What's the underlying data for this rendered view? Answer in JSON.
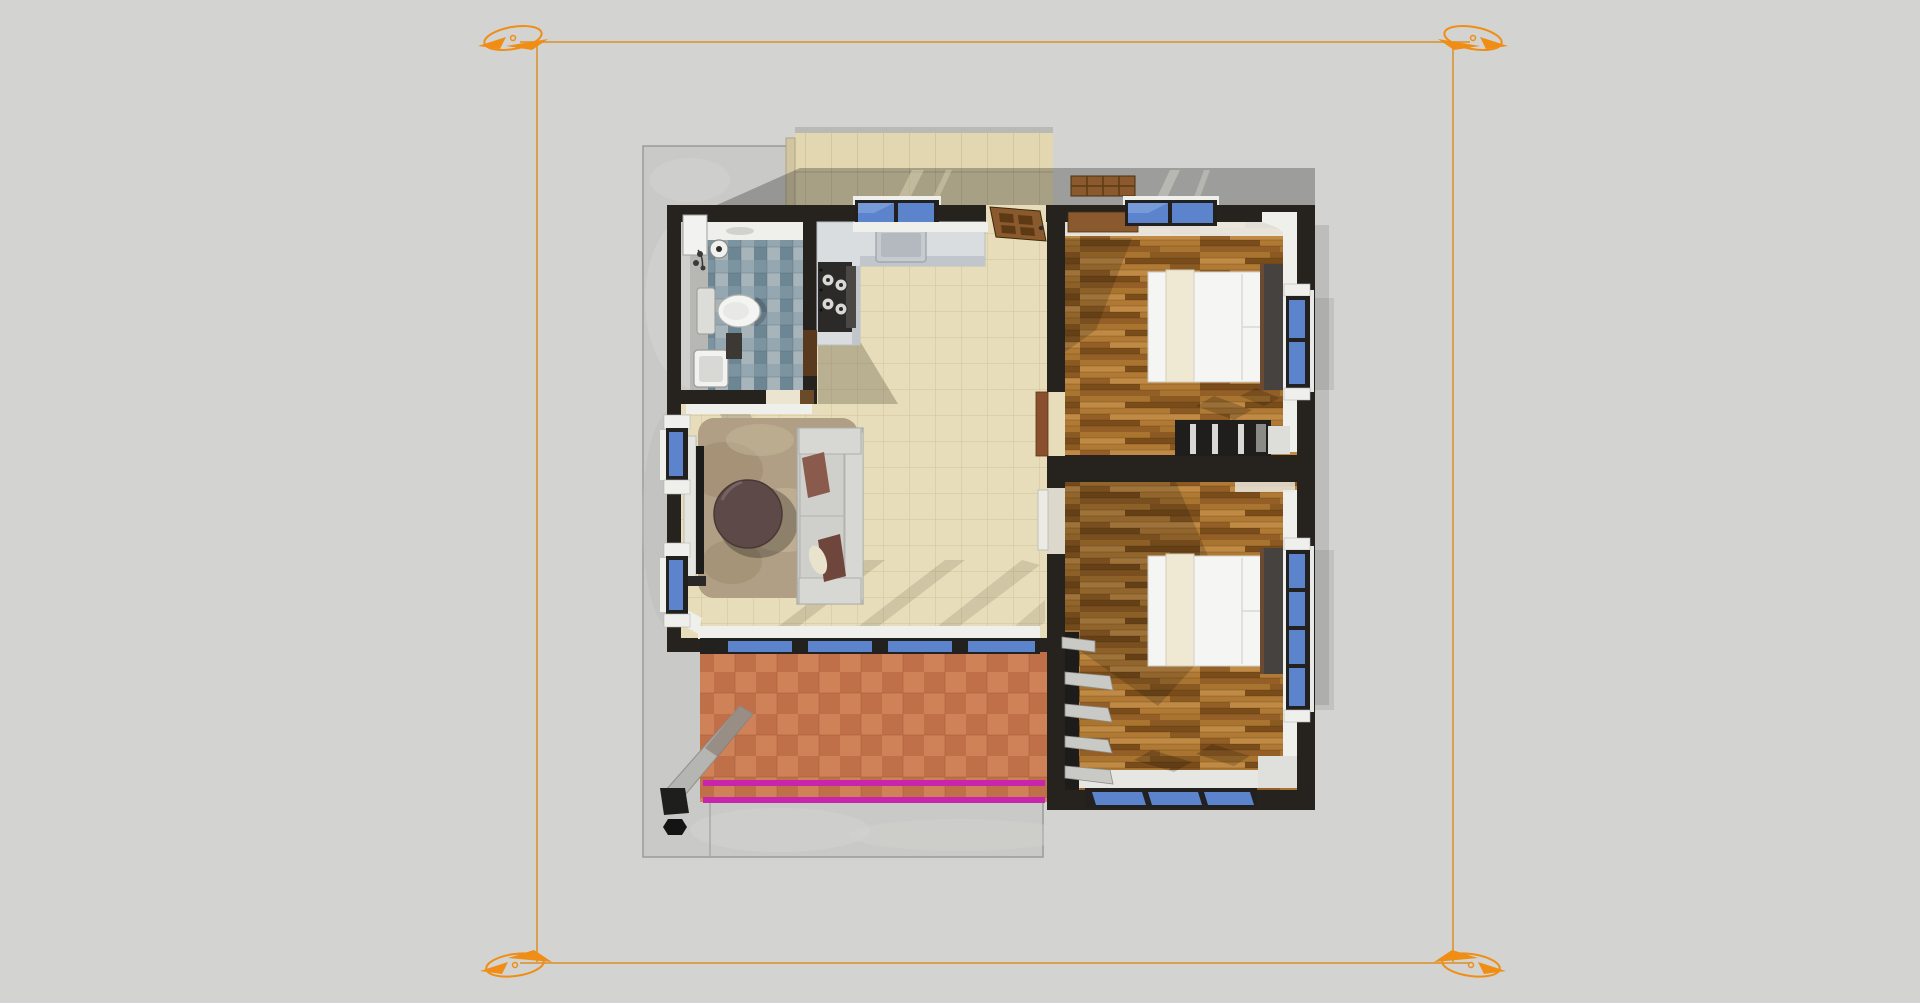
{
  "scene": {
    "type": "3d-floor-plan-top-view",
    "rooms": [
      {
        "name": "porch"
      },
      {
        "name": "bathroom"
      },
      {
        "name": "kitchen"
      },
      {
        "name": "living-room"
      },
      {
        "name": "bedroom-1"
      },
      {
        "name": "bedroom-2"
      },
      {
        "name": "terrace"
      }
    ],
    "furniture": [
      {
        "name": "toilet"
      },
      {
        "name": "bathroom-vanity-sink"
      },
      {
        "name": "kitchen-counter"
      },
      {
        "name": "kitchen-sink"
      },
      {
        "name": "stove"
      },
      {
        "name": "entry-door"
      },
      {
        "name": "porch-bench"
      },
      {
        "name": "sofa"
      },
      {
        "name": "coffee-table"
      },
      {
        "name": "area-rug"
      },
      {
        "name": "tv"
      },
      {
        "name": "bed-1"
      },
      {
        "name": "bed-2"
      },
      {
        "name": "wardrobe"
      },
      {
        "name": "shelving-unit"
      },
      {
        "name": "downspout-post"
      }
    ],
    "guides": [
      {
        "name": "section-plane-frame"
      },
      {
        "name": "section-corner-markers",
        "count": 4
      },
      {
        "name": "terrace-edge-lines-magenta",
        "count": 2
      }
    ]
  },
  "colors": {
    "bg": "#d3d3d1",
    "pad": "#c9c9c7",
    "wall": "#26231f",
    "porch": "#e2d7b0",
    "floor": "#e7ddba",
    "grout": "#cfc39b",
    "bath_a": "#7c93a0",
    "bath_b": "#95a7b0",
    "bath_c": "#6d8694",
    "bath_d": "#a7b4ba",
    "vanity": "#b7b7b3",
    "marble": "#d9dde0",
    "marble_edge": "#c0c6cb",
    "stove": "#2c2a28",
    "glass": "#5b84cc",
    "glass_hi": "#83a4de",
    "frame": "#23211f",
    "sill": "#efefeb",
    "wood1": "#a9742f",
    "wood2": "#8a5a22",
    "wood3": "#c08a45",
    "wood4": "#7a4c1a",
    "wood5": "#b07a35",
    "wood6": "#935f26",
    "bed": "#f5f5f3",
    "bed_cream": "#efe8d2",
    "headboard": "#454240",
    "headboard_edge": "#6b4a33",
    "sofa": "#c9c9c5",
    "sofa_hi": "#d7d7d3",
    "pillow1": "#8a5a4d",
    "pillow2": "#6f463c",
    "pillow_cream": "#e9e3ce",
    "rug": "#b19f85",
    "rug_dk": "#9c8a6e",
    "rug_lt": "#c6b89a",
    "table": "#5d4947",
    "terra1": "#cf8157",
    "terra2": "#c07048",
    "magenta": "#c824ac",
    "door": "#8a5a2e",
    "door_panel": "#5e3a14",
    "orange": "#ef8d15",
    "orange_line": "#d9a050",
    "toilet": "#f4f4f2",
    "fixture_gray": "#dcdcd8"
  }
}
